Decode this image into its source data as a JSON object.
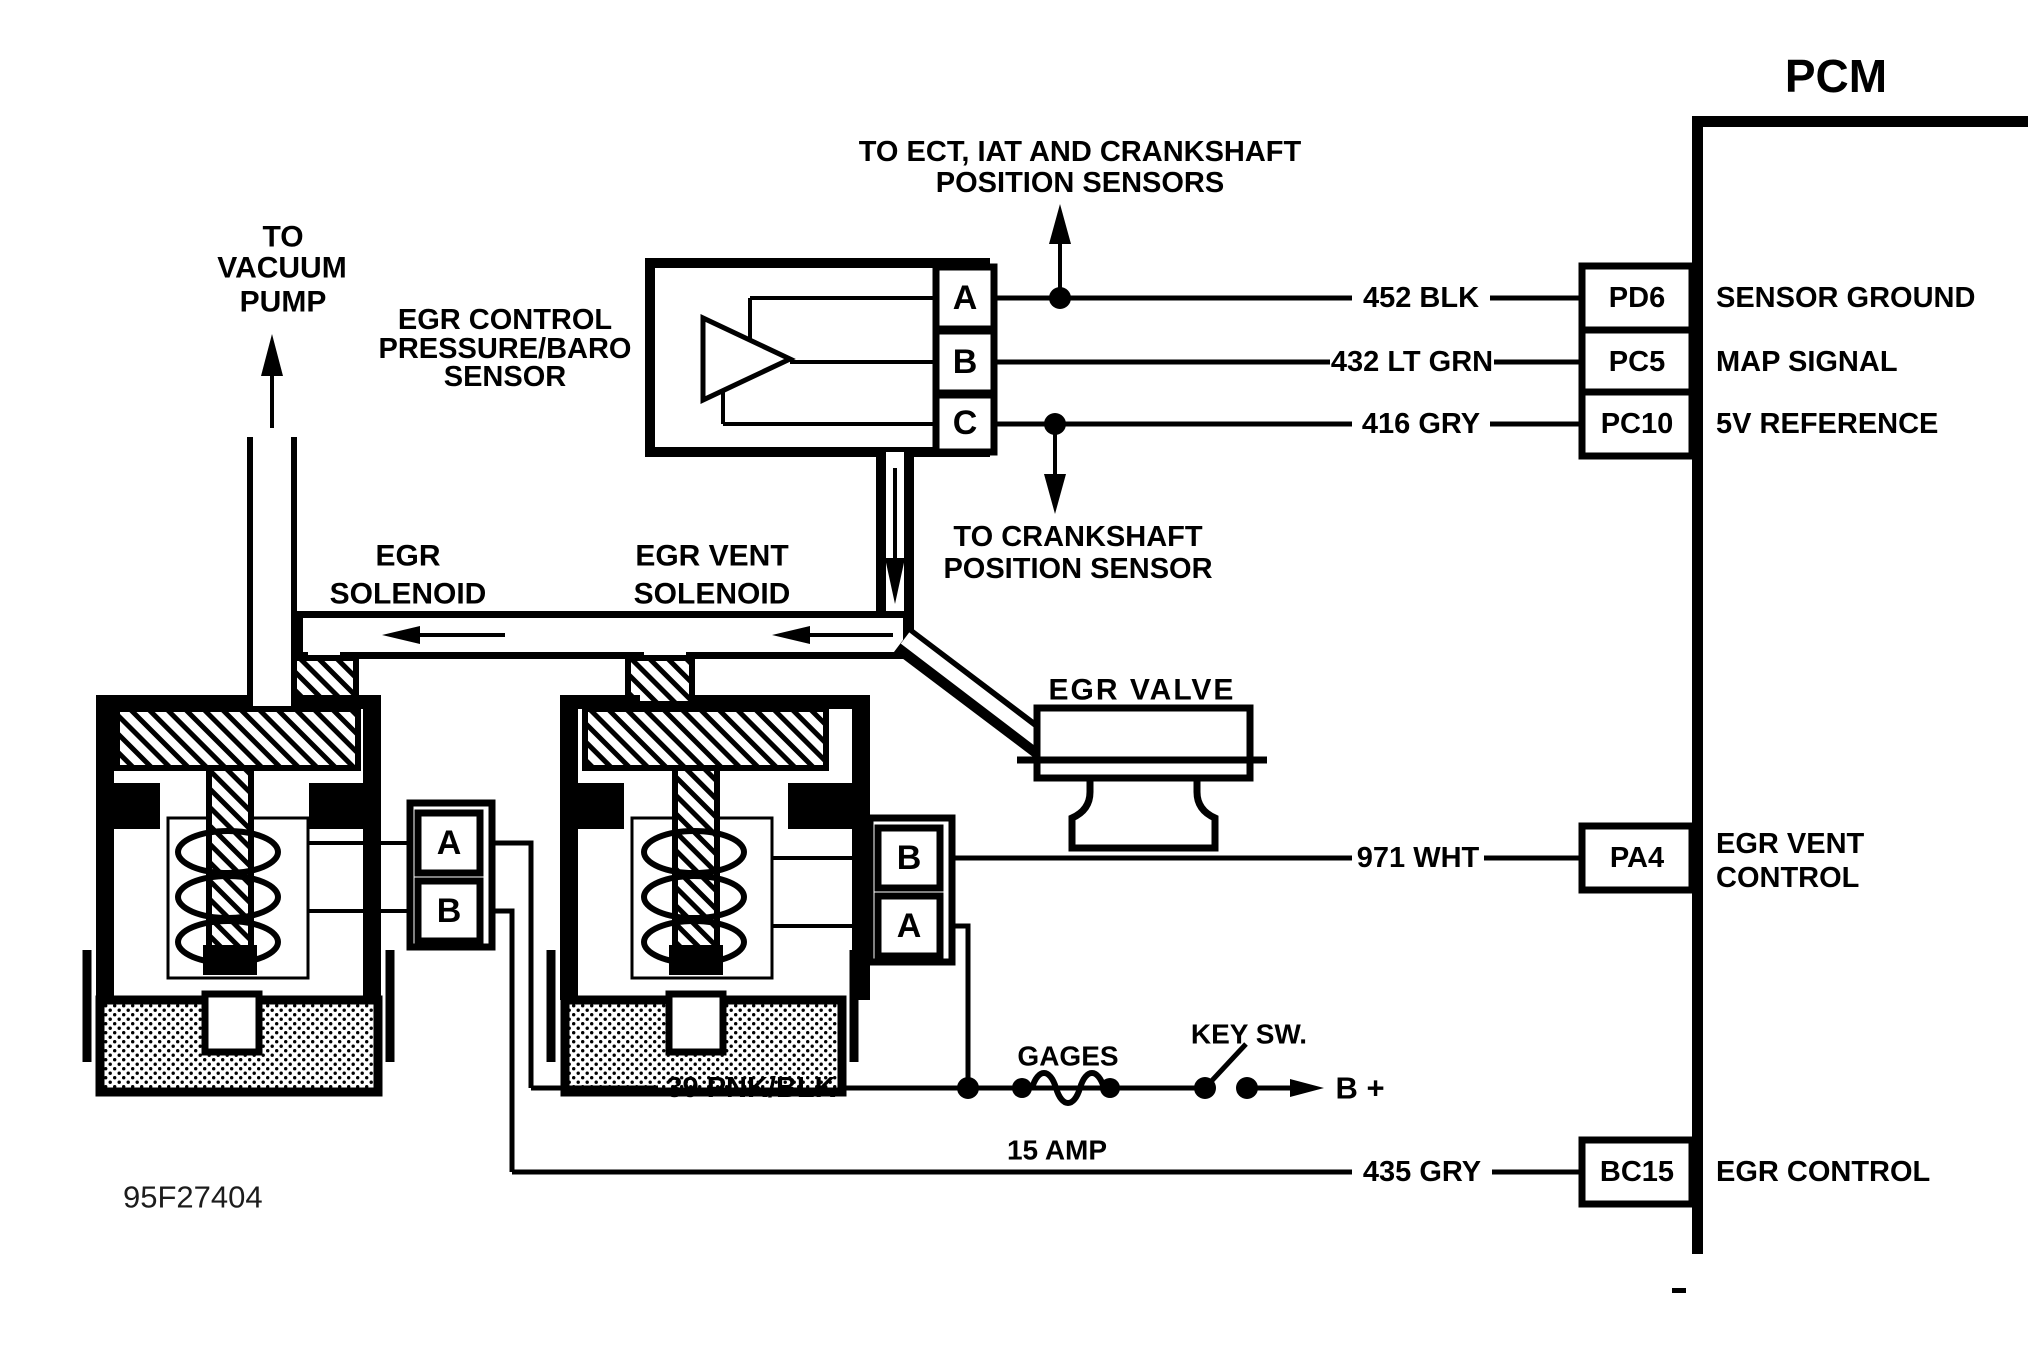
{
  "pcm": {
    "title": "PCM",
    "pins": [
      {
        "id": "PD6",
        "function": "SENSOR GROUND",
        "wire": "452 BLK"
      },
      {
        "id": "PC5",
        "function": "MAP SIGNAL",
        "wire": "432 LT GRN"
      },
      {
        "id": "PC10",
        "function": "5V REFERENCE",
        "wire": "416 GRY"
      },
      {
        "id": "PA4",
        "function_line1": "EGR VENT",
        "function_line2": "CONTROL",
        "wire": "971 WHT"
      },
      {
        "id": "BC15",
        "function": "EGR CONTROL",
        "wire": "435 GRY"
      }
    ]
  },
  "components": {
    "vacuum_pump": {
      "label_line1": "TO",
      "label_line2": "VACUUM",
      "label_line3": "PUMP"
    },
    "map_sensor": {
      "label_line1": "EGR CONTROL",
      "label_line2": "PRESSURE/BARO",
      "label_line3": "SENSOR",
      "pins": [
        "A",
        "B",
        "C"
      ]
    },
    "egr_solenoid": {
      "label_line1": "EGR",
      "label_line2": "SOLENOID",
      "pins": [
        "A",
        "B"
      ]
    },
    "egr_vent_solenoid": {
      "label_line1": "EGR VENT",
      "label_line2": "SOLENOID",
      "pins": [
        "B",
        "A"
      ]
    },
    "egr_valve": {
      "label": "EGR VALVE"
    }
  },
  "annotations": {
    "ect_line1": "TO ECT, IAT AND CRANKSHAFT",
    "ect_line2": "POSITION SENSORS",
    "crank_line1": "TO CRANKSHAFT",
    "crank_line2": "POSITION SENSOR",
    "ignition_wire": "39 PNK/BLK",
    "fuse_name": "GAGES",
    "fuse_rating": "15 AMP",
    "key_switch": "KEY SW.",
    "battery": "B +",
    "figure_id": "95F27404"
  },
  "colors": {
    "ink": "#000000",
    "background": "#ffffff"
  }
}
